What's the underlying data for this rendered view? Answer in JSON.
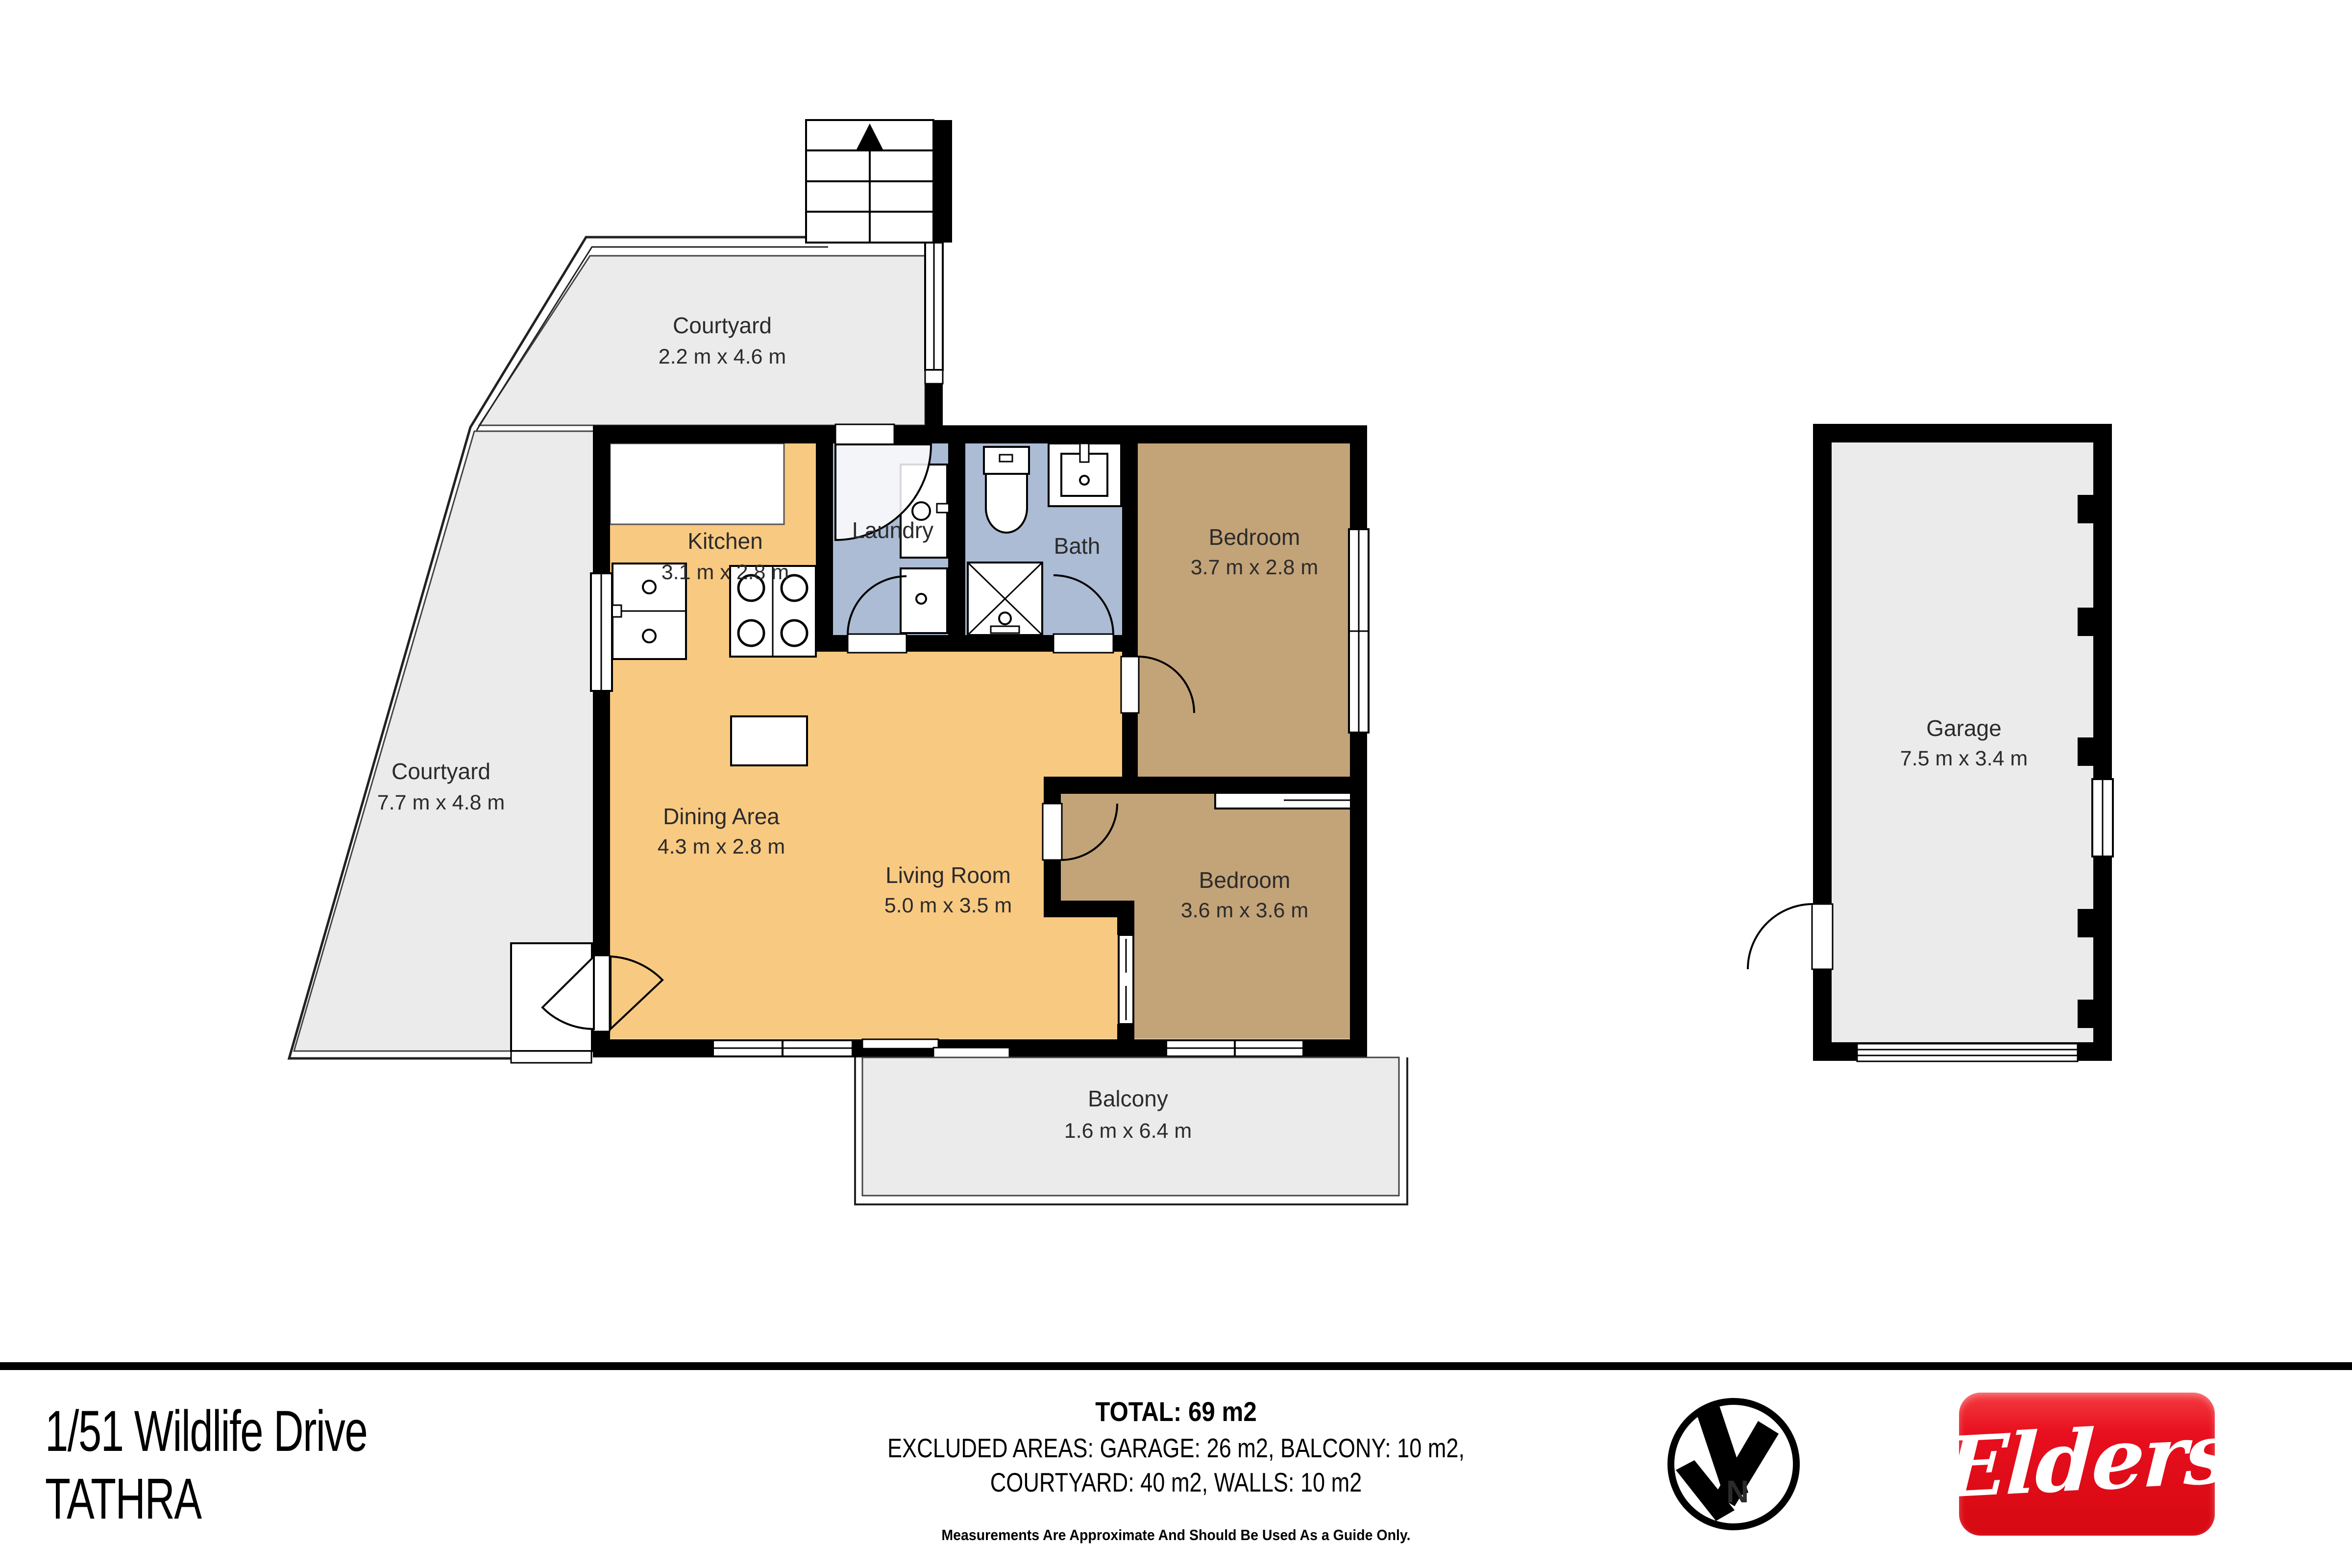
{
  "plan": {
    "rooms": {
      "courtyard_top": {
        "name": "Courtyard",
        "dims": "2.2 m x 4.6 m"
      },
      "courtyard_left": {
        "name": "Courtyard",
        "dims": "7.7 m x 4.8 m"
      },
      "kitchen": {
        "name": "Kitchen",
        "dims": "3.1 m x 2.8 m"
      },
      "laundry": {
        "name": "Laundry"
      },
      "bath": {
        "name": "Bath"
      },
      "bedroom1": {
        "name": "Bedroom",
        "dims": "3.7 m x 2.8 m"
      },
      "dining": {
        "name": "Dining Area",
        "dims": "4.3 m x 2.8 m"
      },
      "living": {
        "name": "Living Room",
        "dims": "5.0 m x 3.5 m"
      },
      "bedroom2": {
        "name": "Bedroom",
        "dims": "3.6 m x 3.6 m"
      },
      "balcony": {
        "name": "Balcony",
        "dims": "1.6 m x 6.4 m"
      },
      "garage": {
        "name": "Garage",
        "dims": "7.5 m x 3.4 m"
      }
    },
    "colors": {
      "floor_orange": "#f8c981",
      "floor_tan": "#c3a378",
      "floor_blue": "#abbcd4",
      "outdoor_gray": "#ebebeb",
      "wall_black": "#000000"
    }
  },
  "footer": {
    "address_line1": "1/51 Wildlife Drive",
    "address_line2": "TATHRA",
    "total": "TOTAL: 69 m2",
    "excluded_line1": "EXCLUDED AREAS: GARAGE: 26 m2,  BALCONY: 10 m2,",
    "excluded_line2": "COURTYARD: 40 m2, WALLS: 10 m2",
    "disclaimer": "Measurements Are Approximate And Should Be Used As a Guide Only.",
    "compass_label": "N",
    "brand": "Elders",
    "brand_color": "#e8101e"
  }
}
